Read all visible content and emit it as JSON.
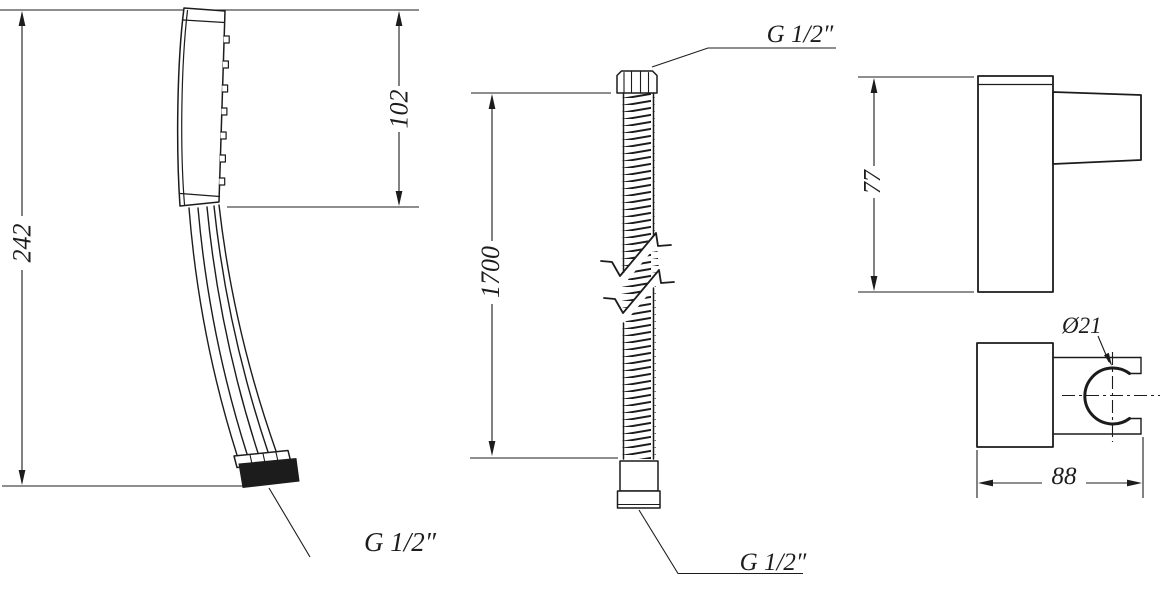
{
  "drawing": {
    "line_color": "#1c1c1c",
    "background_color": "#ffffff"
  },
  "handset": {
    "overall_length": "242",
    "head_length": "102",
    "thread": "G 1/2″"
  },
  "hose": {
    "length": "1700",
    "thread_top": "G 1/2″",
    "thread_bottom": "G 1/2″"
  },
  "holder": {
    "height": "77",
    "width": "88",
    "clamp_diameter": "Ø21"
  }
}
